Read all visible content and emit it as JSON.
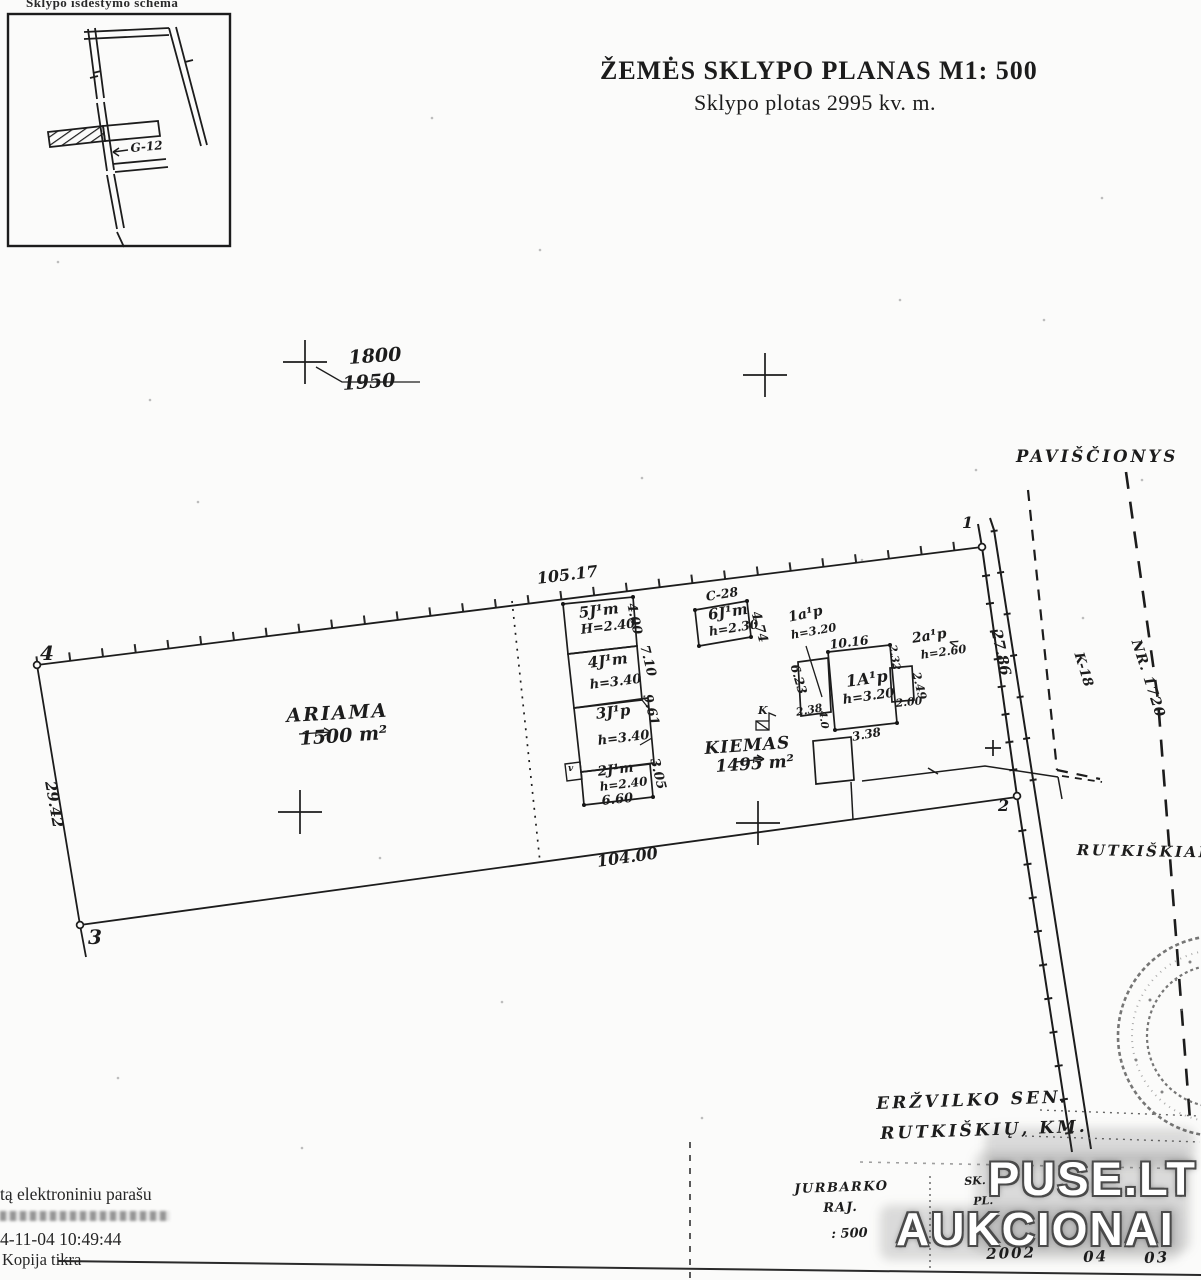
{
  "inset": {
    "caption": "Sklypo išdėstymo schema",
    "road_label": "G-12"
  },
  "title": {
    "line1": "ŽEMĖS  SKLYPO  PLANAS M1: 500",
    "line2": "Sklypo plotas   2995 kv. m."
  },
  "grid": {
    "elev_top": "1800",
    "elev_bottom": "1950"
  },
  "parcel": {
    "vertex_1": "1",
    "vertex_2": "2",
    "vertex_3": "3",
    "vertex_4": "4",
    "dim_top": "105.17",
    "dim_bottom": "104.00",
    "dim_left": "29.42",
    "dim_right": "27.86",
    "ariama_label": "ARIAMA",
    "ariama_area": "1500 m²",
    "kiemas_label": "KIEMAS",
    "kiemas_area": "1495 m²",
    "well_label": "K",
    "angle_mark": "<"
  },
  "buildings": {
    "b5_code": "5J¹m",
    "b5_height": "H=2.40",
    "b4_code": "4J¹m",
    "b4_height": "h=3.40",
    "b3_code": "3J¹p",
    "b3_height": "h=3.40",
    "b2_code": "2J¹m",
    "b2_height": "h=2.40",
    "b6_ref": "C-28",
    "b6_code": "6J¹m",
    "b6_height": "h=2.30",
    "house_code": "1A¹p",
    "house_height": "h=3.20",
    "a1_code": "1a¹p",
    "a1_height": "h=3.20",
    "a2_code": "2a¹p",
    "a2_height": "h=2.60",
    "porch_mark": "v"
  },
  "dims": {
    "col_1": "4.00",
    "col_2": "7.10",
    "col_3": "9.61",
    "col_4": "3.05",
    "col_w": "6.60",
    "b6_w": "4.74",
    "house_top": "10.16",
    "house_left": "6.23",
    "d238": "2.38",
    "d40": "4.0",
    "d338": "3.38",
    "d200": "2.00",
    "d249": "2.49",
    "d232": "2.32"
  },
  "places": {
    "north_village": "PAVIŠČIONYS",
    "south_village": "RUTKIŠKIAI",
    "road_k18": "K-18",
    "road_nr": "NR. 1720"
  },
  "notes": {
    "sen": "ERŽVILKO  SEN.",
    "km": "RUTKIŠKIŲ,  KM.",
    "district": "JURBARKO",
    "raj": "RAJ.",
    "scale": ": 500",
    "sk": "SK.",
    "pl": "PL.",
    "date": [
      "2002",
      "04",
      "03"
    ]
  },
  "watermark": {
    "line1": "PUSE.LT",
    "line2": "AUKCIONAI"
  },
  "signature": {
    "line1": "tą elektroniniu parašu",
    "line2": "4-11-04 10:49:44",
    "line3": "Kopija tikra"
  }
}
